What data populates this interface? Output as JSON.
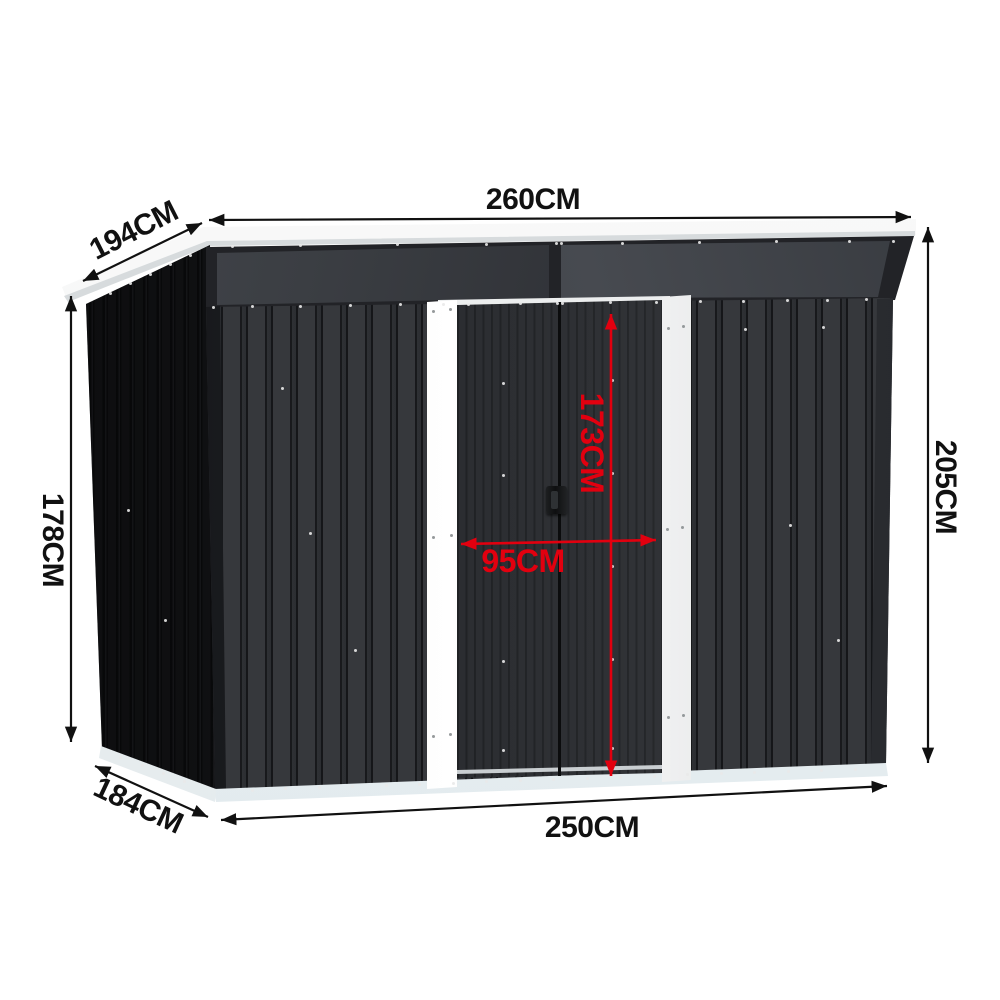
{
  "title": "Metal pent-roof garden shed dimension diagram",
  "dims": {
    "roof_width": "260CM",
    "roof_depth": "194CM",
    "height_left": "178CM",
    "height_right": "205CM",
    "base_depth": "184CM",
    "base_width": "250CM",
    "door_height": "173CM",
    "door_width": "95CM"
  },
  "colors": {
    "dimension_black": "#111111",
    "dimension_red": "#e2000f",
    "wall_dark": "#35373b",
    "side_wall": "#141518",
    "gable_dark": "#2a2c30",
    "roof_white": "#f7f8f8",
    "frame_white": "#f4f4f4",
    "base_light": "#edf3f5",
    "door_dark": "#2b2d31",
    "handle_black": "#121315"
  }
}
